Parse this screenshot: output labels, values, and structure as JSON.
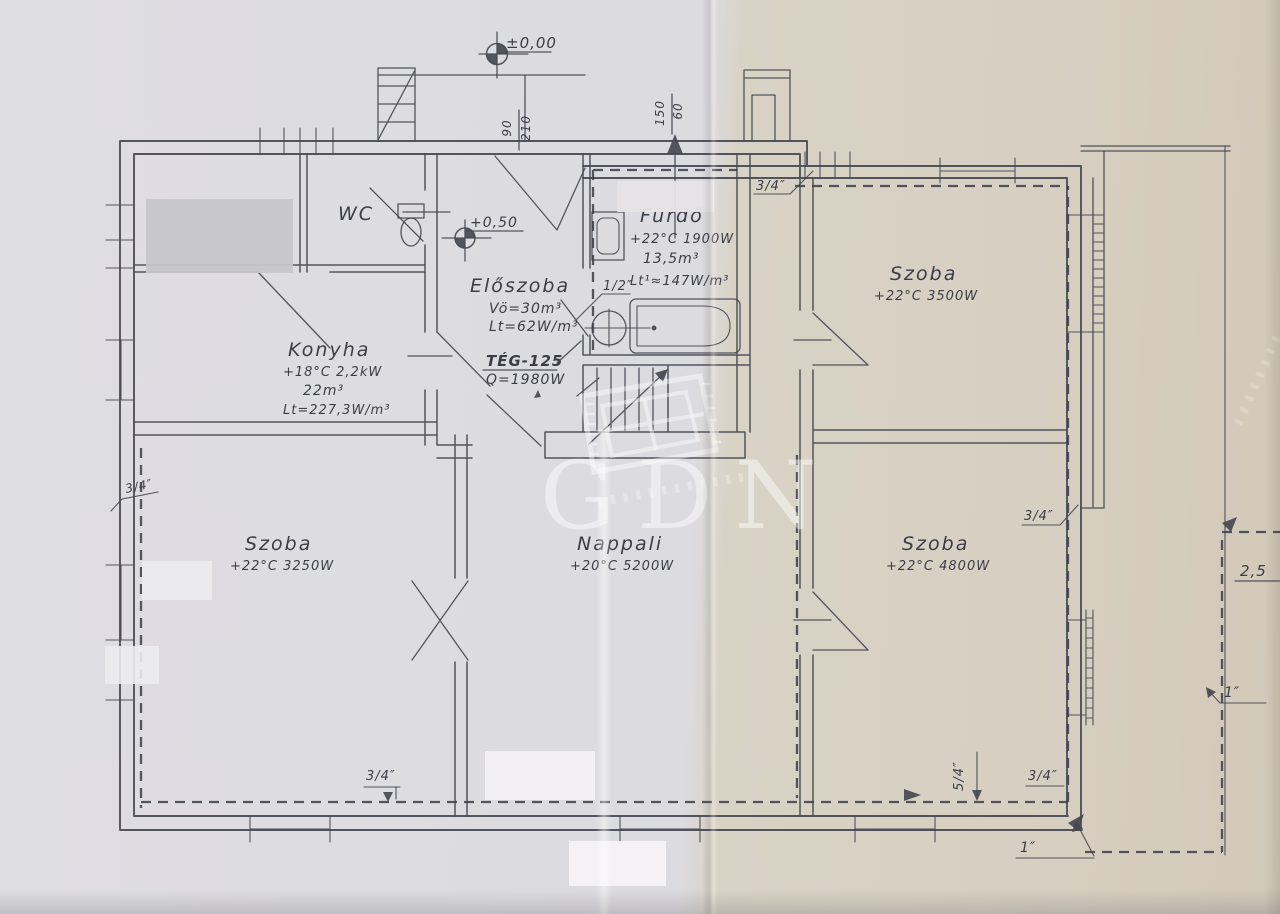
{
  "scan": {
    "watermark_brand": "GDN"
  },
  "levels": {
    "ground": "±0,00",
    "entry": "+0,50"
  },
  "dims": {
    "door_width": "90",
    "door_height": "210",
    "vent_width": "150",
    "vent_height": "60",
    "right_offset": "2,5"
  },
  "rooms": {
    "wc": {
      "name": "WC"
    },
    "eloszoba": {
      "name": "Előszoba",
      "volume": "Vö=30m³",
      "load": "Lt=62W/m³"
    },
    "furdo": {
      "name": "Fürdő",
      "heat": "+22°C 1900W",
      "volume": "13,5m³",
      "load": "Lt¹≈147W/m³"
    },
    "konyha": {
      "name": "Konyha",
      "heat": "+18°C 2,2kW",
      "volume": "22m³",
      "load": "Lt=227,3W/m³"
    },
    "szoba_felso": {
      "name": "Szoba",
      "heat": "+22°C 3500W"
    },
    "szoba_bal": {
      "name": "Szoba",
      "heat": "+22°C 3250W"
    },
    "nappali": {
      "name": "Nappali",
      "heat": "+20°C 5200W"
    },
    "szoba_jobb": {
      "name": "Szoba",
      "heat": "+22°C 4800W"
    }
  },
  "boiler": {
    "model": "TÉG-125",
    "output": "Q=1980W"
  },
  "pipes": {
    "half_inch": "1/2″",
    "three_quarter_inch": "3/4″",
    "five_quarter_inch": "5/4″",
    "one_inch": "1″"
  },
  "colors": {
    "ink": "#474951",
    "paper_left": "#dcdbe0",
    "paper_right": "#d6cec0",
    "watermark": "#ffffff"
  }
}
